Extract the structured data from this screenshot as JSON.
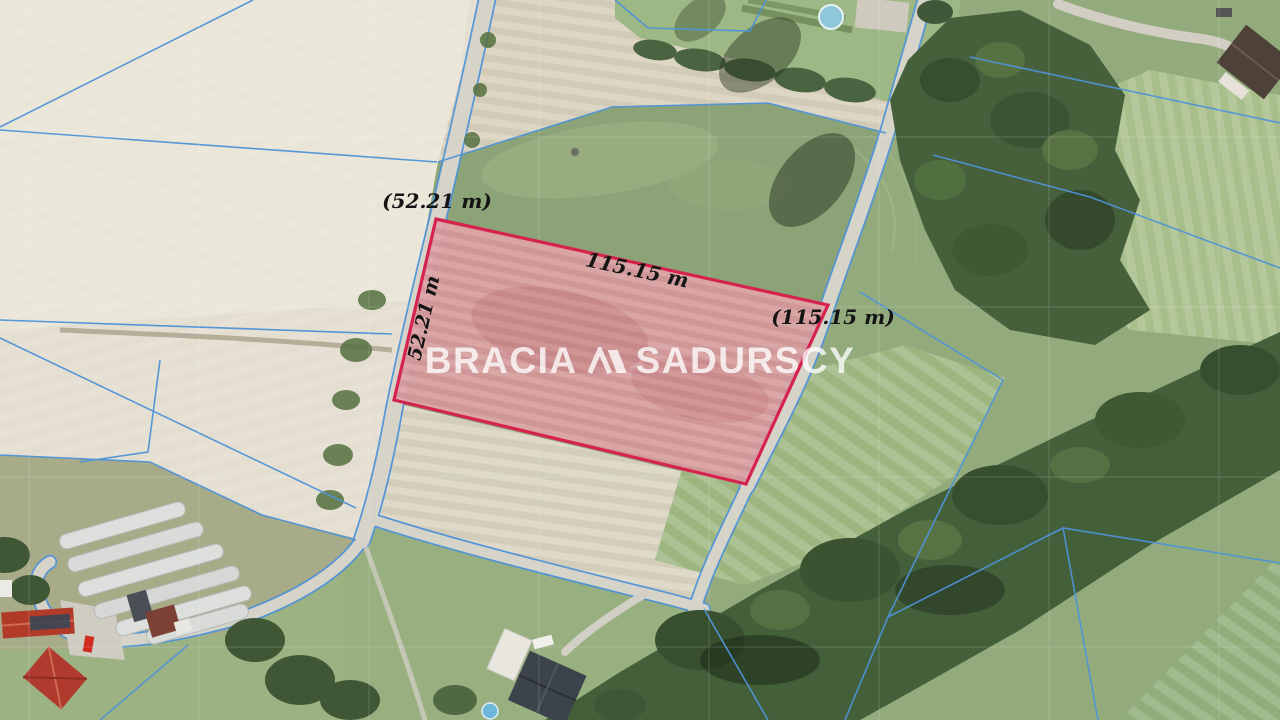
{
  "parcel": {
    "label_top": "(52.21 m)",
    "label_along_top_edge": "115.15 m",
    "label_right": "(115.15 m)",
    "label_along_left_edge": "52.21 m"
  },
  "watermark": {
    "brand_word_1": "BRACIA",
    "brand_word_2": "SADURSCY",
    "logo_icon": "bracia-sadurscy-roofs-logo"
  },
  "colors": {
    "parcel_fill": "#dfa6a9",
    "parcel_outline": "#d6234e",
    "cadastral_line": "#4f93d8",
    "dimension_text": "#141414",
    "watermark_text": "rgba(255,255,255,0.78)"
  }
}
